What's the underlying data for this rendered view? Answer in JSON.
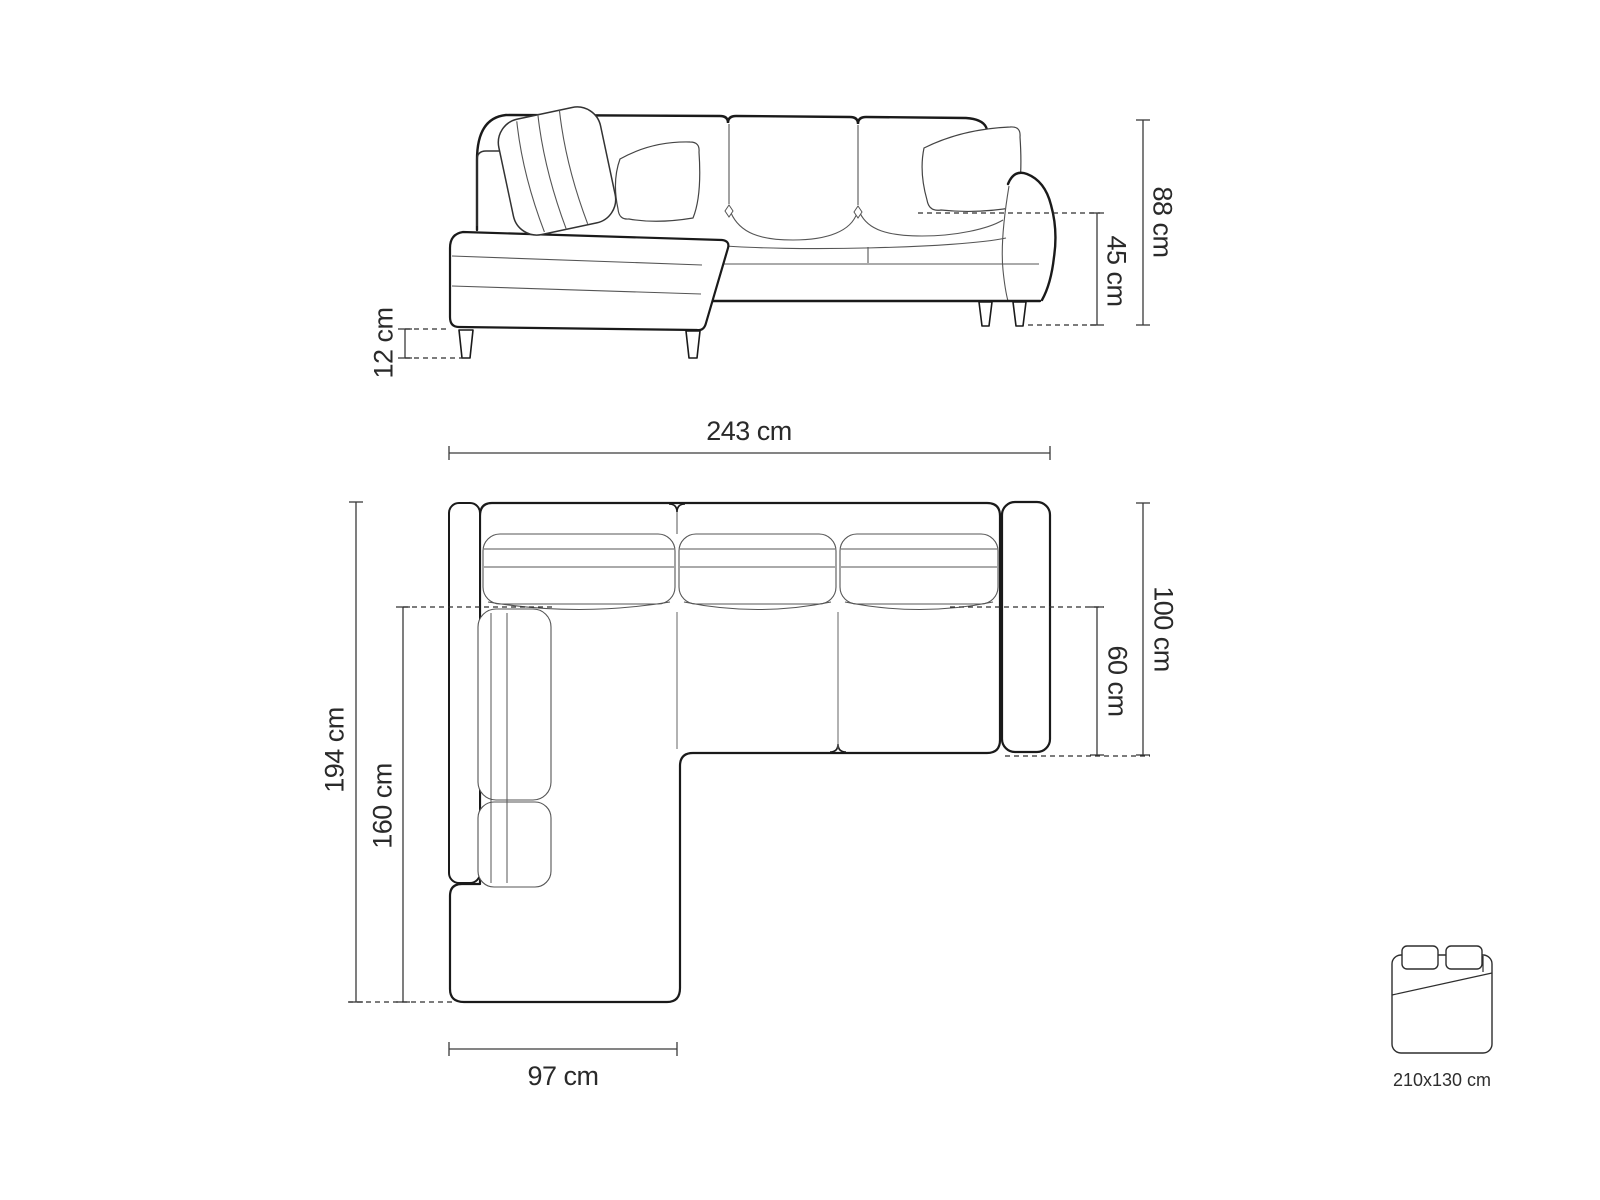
{
  "elevation": {
    "dim_total_height": "88 cm",
    "dim_seat_height": "45 cm",
    "dim_leg_height": "12 cm"
  },
  "plan": {
    "dim_total_width": "243 cm",
    "dim_total_depth": "194 cm",
    "dim_chaise_length": "160 cm",
    "dim_body_depth": "100 cm",
    "dim_seat_depth": "60 cm",
    "dim_chaise_width": "97 cm"
  },
  "sleeping_area": {
    "icon": "bed-icon",
    "label": "210x130 cm"
  },
  "colors": {
    "outline": "#1a1a1a",
    "secondary_line": "#555555",
    "dimension_line": "#3a3a3a",
    "text": "#2a2a2a",
    "background": "#ffffff"
  }
}
